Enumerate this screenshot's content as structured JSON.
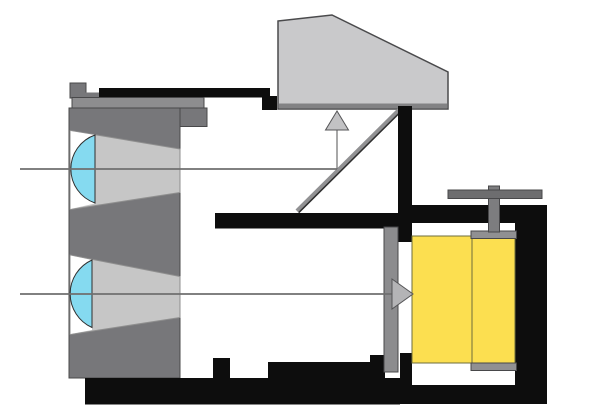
{
  "diagram": {
    "kind": "camera-cross-section-schematic",
    "description": "Cutaway side-view diagram of a reflex camera: twin lens barrel with two cyan lens elements and light cones, incoming light rays, 45-degree mirror reflecting one ray up into a grey viewfinder prism, second ray passing to the film plane, yellow film roll with take-up spool and winding knob inside the black camera body",
    "components": [
      "lens-barrel",
      "upper-lens-element",
      "lower-lens-element",
      "upper-light-cone",
      "lower-light-cone",
      "upper-light-ray",
      "lower-light-ray",
      "mirror",
      "viewfinder-prism",
      "up-arrow",
      "right-arrow",
      "camera-body",
      "internal-divider",
      "mirror-box-wall",
      "shutter-plate",
      "film-roll",
      "takeup-spool",
      "winding-knob"
    ]
  },
  "colors": {
    "background": "#ffffff",
    "body_black": "#0d0d0d",
    "barrel_gray": "#77777a",
    "barrel_top_gray": "#8d8d8f",
    "cone_gray": "#c6c6c6",
    "cone_edge": "#8f8f8f",
    "chamber_white": "#ffffff",
    "lens_cyan": "#85daf0",
    "lens_outline": "#2f2f2f",
    "prism_gray": "#c9c9cb",
    "prism_base_gray": "#828284",
    "prism_outline": "#4a4a4c",
    "mirror_gray": "#919193",
    "mirror_edge": "#2e2e2e",
    "ray_gray": "#6f6f6f",
    "arrow_up_fill": "#c2c2c4",
    "arrow_right_fill": "#b4b4b6",
    "arrow_stroke": "#555557",
    "shutter_gray": "#8c8c8e",
    "knob_gray": "#6d6d6f",
    "knob_stem_gray": "#7d7d7f",
    "film_yellow": "#fcdf50",
    "film_outline": "#6e6e3c",
    "spool_cap_gray": "#909092",
    "outline_dark": "#48484a"
  }
}
